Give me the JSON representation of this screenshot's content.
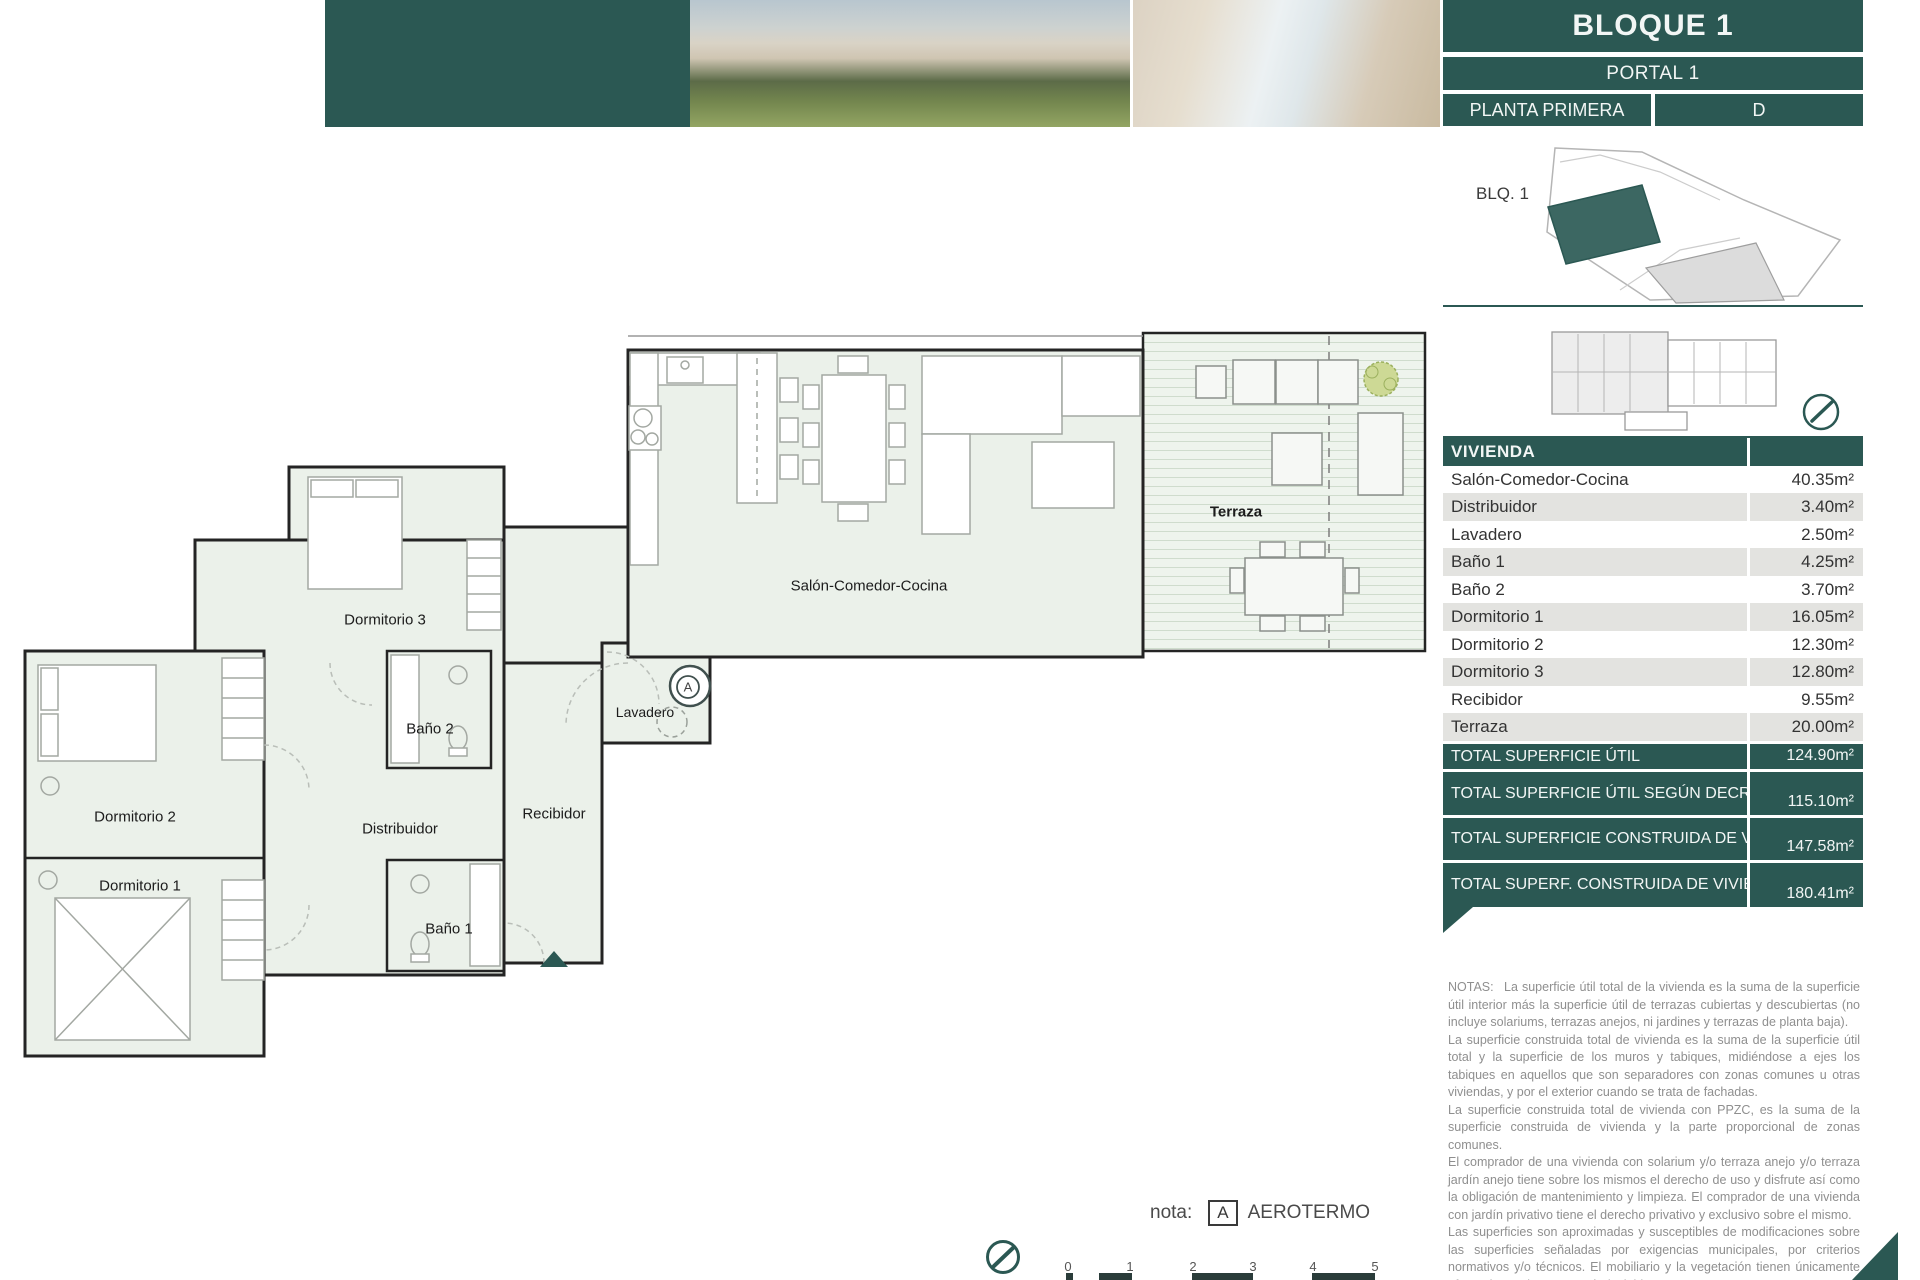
{
  "header": {
    "title": "BLOQUE 1",
    "portal": "PORTAL 1",
    "floor": "PLANTA PRIMERA",
    "unit": "D"
  },
  "siteplan": {
    "block_label": "BLQ. 1"
  },
  "table": {
    "header": "VIVIENDA",
    "rows": [
      {
        "label": "Salón-Comedor-Cocina",
        "value": "40.35m²"
      },
      {
        "label": "Distribuidor",
        "value": "3.40m²"
      },
      {
        "label": "Lavadero",
        "value": "2.50m²"
      },
      {
        "label": "Baño 1",
        "value": "4.25m²"
      },
      {
        "label": "Baño 2",
        "value": "3.70m²"
      },
      {
        "label": "Dormitorio 1",
        "value": "16.05m²"
      },
      {
        "label": "Dormitorio 2",
        "value": "12.30m²"
      },
      {
        "label": "Dormitorio 3",
        "value": "12.80m²"
      },
      {
        "label": "Recibidor",
        "value": "9.55m²"
      },
      {
        "label": "Terraza",
        "value": "20.00m²"
      }
    ],
    "totals": [
      {
        "label": "TOTAL SUPERFICIE ÚTIL",
        "value": "124.90m²"
      },
      {
        "label": "TOTAL SUPERFICIE ÚTIL SEGÚN DECRETO 218/2005*",
        "value": "115.10m²"
      },
      {
        "label": "TOTAL SUPERFICIE CONSTRUIDA DE VIVIENDA",
        "value": "147.58m²"
      },
      {
        "label": "TOTAL SUPERF. CONSTRUIDA DE VIVIENDA CON PPZC.",
        "value": "180.41m²"
      }
    ]
  },
  "notes": {
    "label": "NOTAS:",
    "paragraphs": [
      "La superficie útil total de la vivienda es la suma de la superficie útil interior más la superficie útil de terrazas cubiertas y descubiertas (no incluye solariums, terrazas anejos, ni jardines y terrazas de planta baja).",
      "La superficie construida total de vivienda es la suma de la superficie útil total y la superficie de los muros y tabiques, midiéndose a ejes los tabiques en aquellos que son separadores con zonas comunes u otras viviendas, y por el exterior cuando se trata de fachadas.",
      "La superficie construida total de vivienda con PPZC, es la suma de la superficie construida de vivienda y la parte proporcional de zonas comunes.",
      "El comprador de una vivienda con solarium y/o terraza anejo y/o terraza jardín anejo tiene sobre los mismos el derecho de uso y disfrute así como la obligación de mantenimiento y limpieza. El comprador de una vivienda con jardín privativo tiene el derecho privativo y exclusivo sobre el mismo.",
      "Las superficies son aproximadas y susceptibles de modificaciones sobre las superficies señaladas por exigencias municipales, por criterios normativos y/o técnicos. El mobiliario y la vegetación tienen únicamente efecto decorativo y no están incluidos.",
      "(*) Anexo 1. Reglamento de información al consumidor en la compraventa y arrendamiento de viviendas en Andalucía."
    ]
  },
  "plan": {
    "labels": {
      "salon": "Salón-Comedor-Cocina",
      "terraza": "Terraza",
      "dormitorio1": "Dormitorio 1",
      "dormitorio2": "Dormitorio 2",
      "dormitorio3": "Dormitorio 3",
      "bano1": "Baño 1",
      "bano2": "Baño 2",
      "distribuidor": "Distribuidor",
      "recibidor": "Recibidor",
      "lavadero": "Lavadero",
      "aerotermo": "A"
    },
    "note": {
      "prefix": "nota:",
      "symbol": "A",
      "text": "AEROTERMO"
    },
    "scale": [
      "0",
      "1",
      "2",
      "3",
      "4",
      "5"
    ]
  },
  "colors": {
    "teal": "#2b5853",
    "row_alt": "#e3e3e0",
    "plan_fill": "#ebf1ea"
  }
}
